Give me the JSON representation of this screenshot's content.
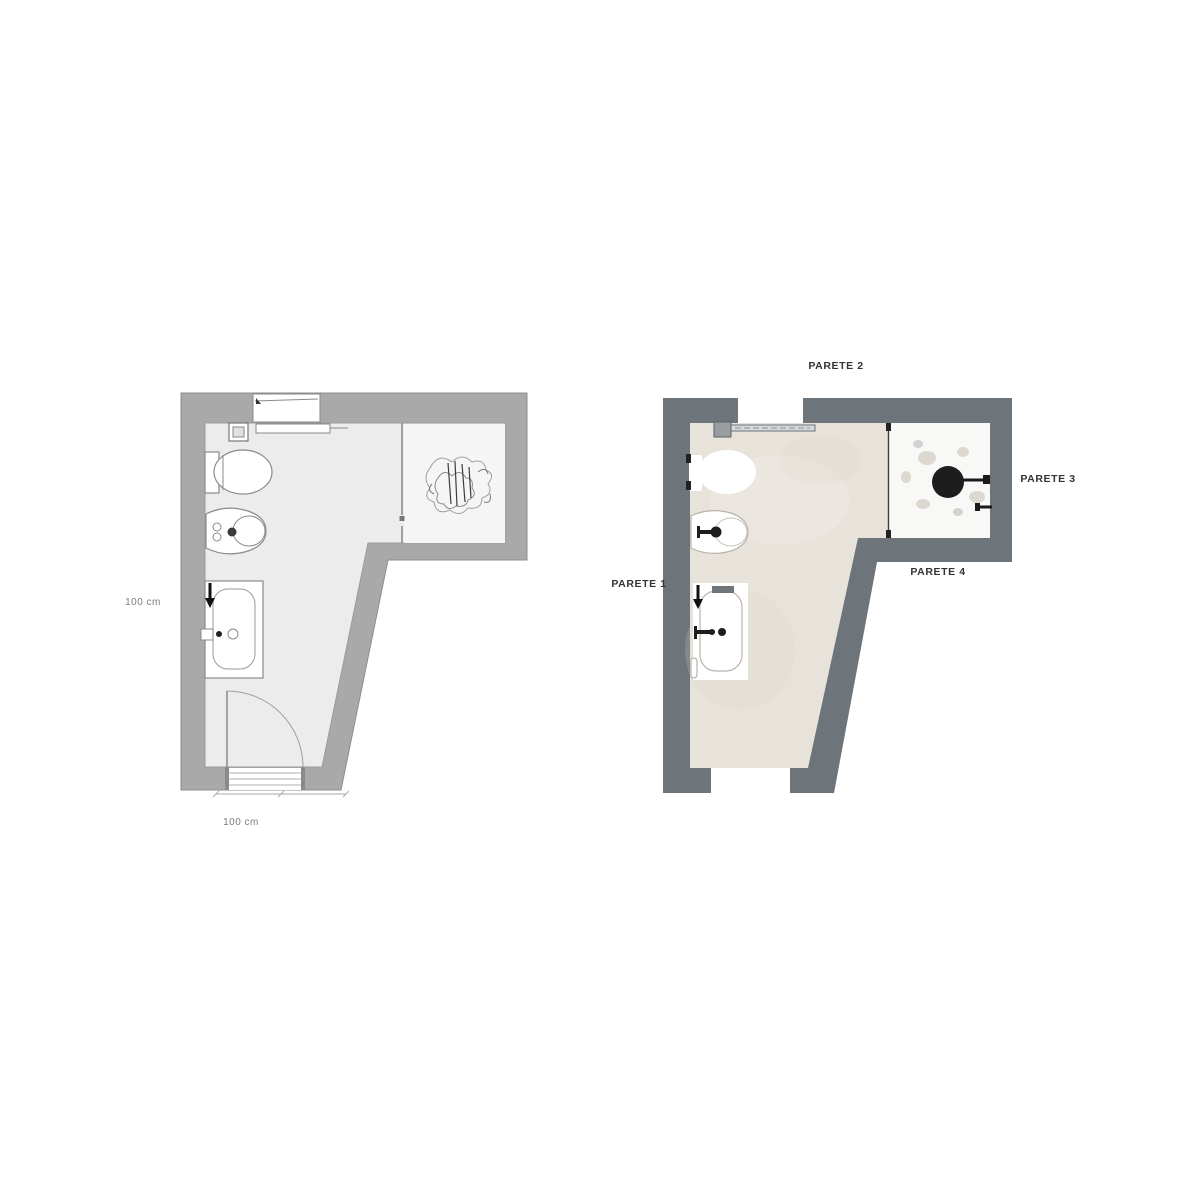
{
  "canvas": {
    "background": "#ffffff"
  },
  "plans": {
    "left": {
      "name": "technical-plan",
      "colors": {
        "wall": "#a9a9a9",
        "wall_outline": "#8d8d8d",
        "floor": "#ececec",
        "shower_floor": "#f5f5f5",
        "line": "#8a8a8a",
        "dark": "#1f1f1f"
      },
      "dimension_side": "100 cm",
      "dimension_bottom": "100 cm",
      "fixtures": [
        "window",
        "radiator",
        "cistern",
        "toilet",
        "bidet",
        "bathtub",
        "shower-screen",
        "shower-sketch",
        "door-swing"
      ]
    },
    "right": {
      "name": "rendered-plan",
      "colors": {
        "wall": "#6d747a",
        "floor": "#e7e2da",
        "floor_blotch": "#cac3b5",
        "shower_floor": "#f8f8f7",
        "fixture": "#ffffff",
        "fixture_outline": "#b8b3aa",
        "accent": "#1d1d1d",
        "label": "#333333"
      },
      "wall_labels": {
        "parete_1": "PARETE 1",
        "parete_2": "PARETE 2",
        "parete_3": "PARETE 3",
        "parete_4": "PARETE 4"
      },
      "fixtures": [
        "window",
        "radiator",
        "toilet",
        "bidet",
        "bathtub",
        "shower-head",
        "door-opening"
      ]
    }
  }
}
